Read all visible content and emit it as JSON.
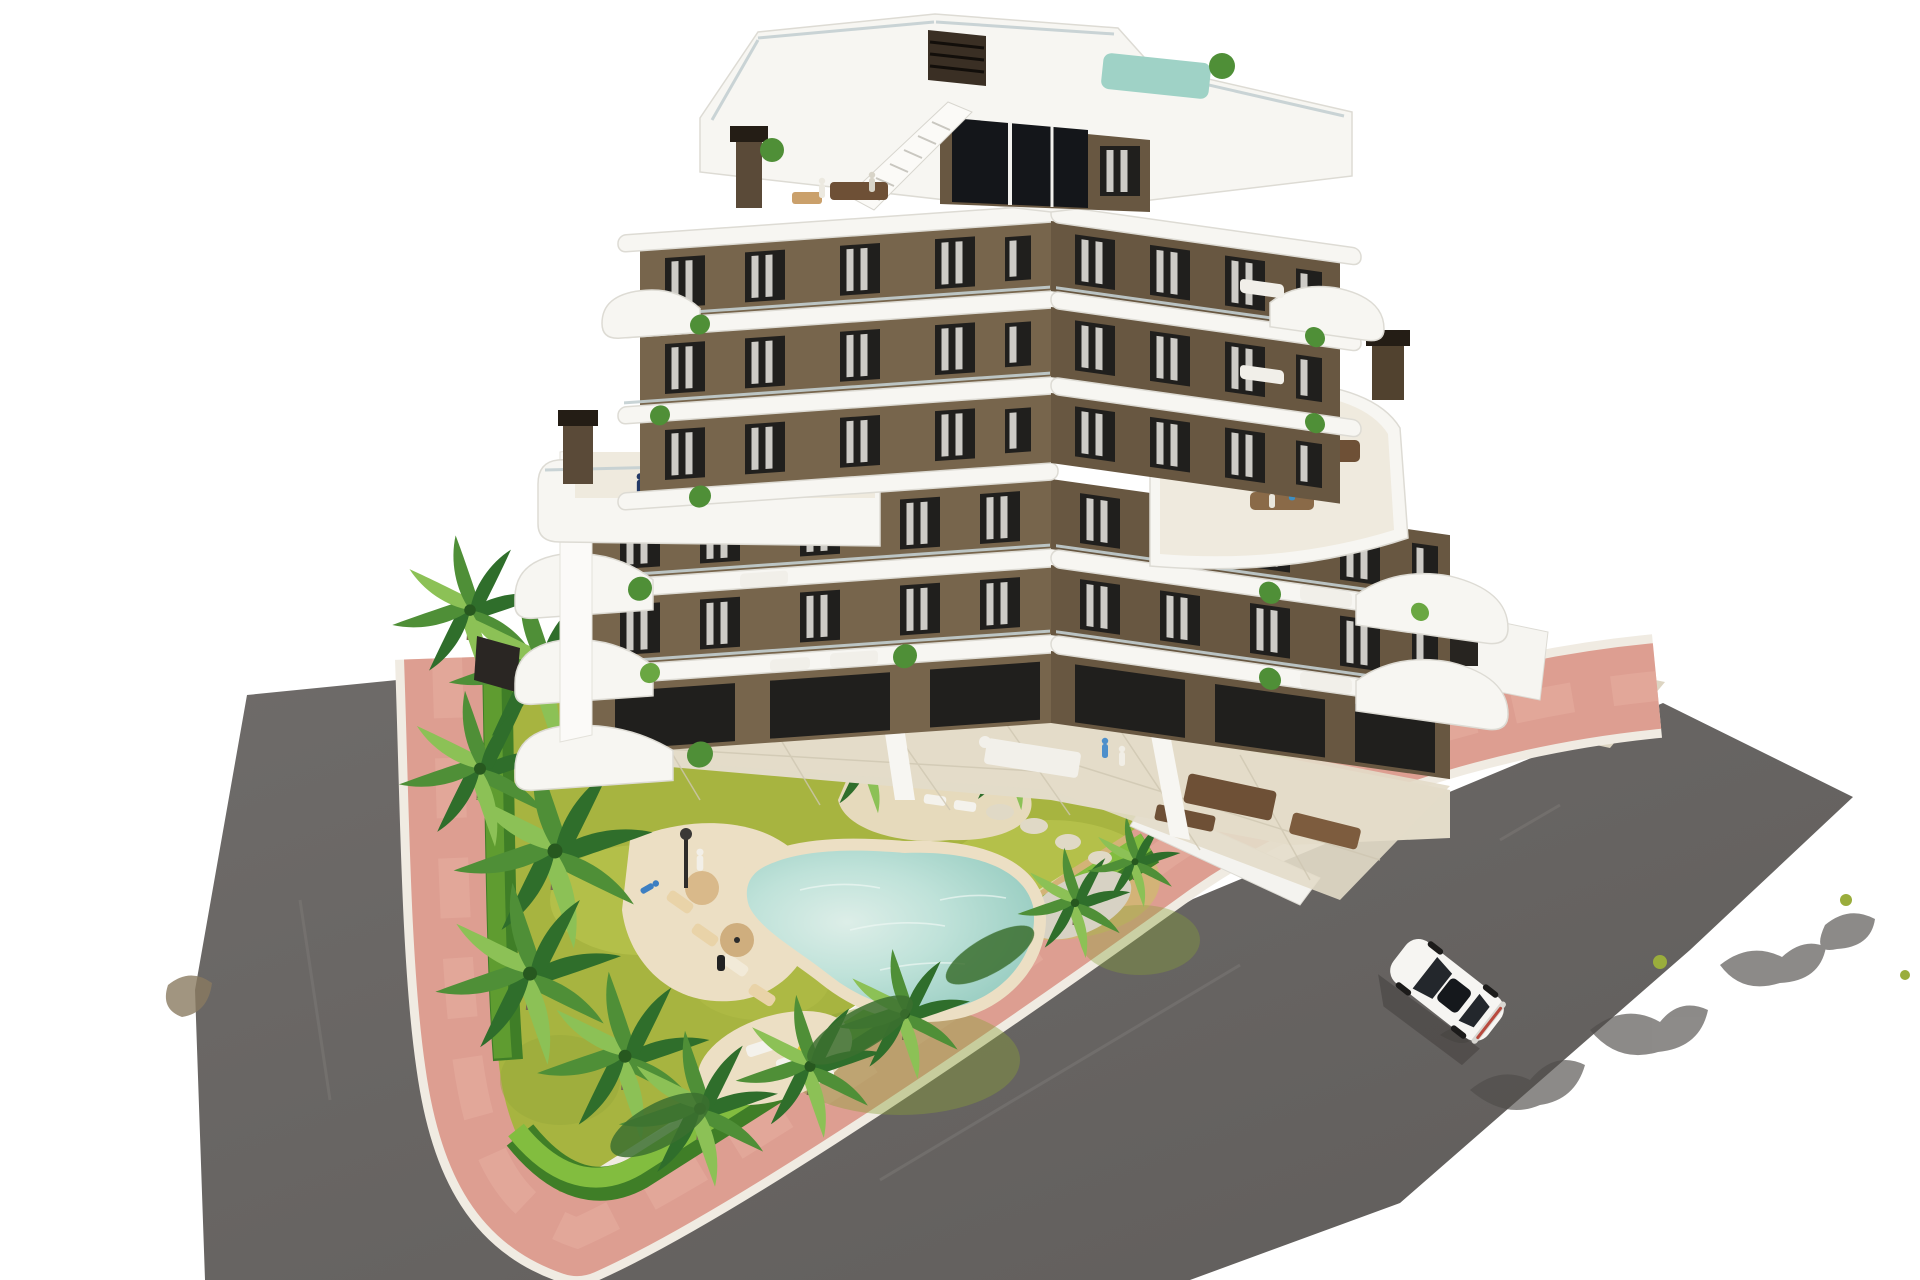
{
  "scene": {
    "title": "Aerial 3D render of modern apartment building with garden, pool and streets",
    "building": {
      "floors_visible": 7,
      "style": "stepped white wavy balcony bands over brown walls",
      "features": [
        "roof deck",
        "rooftop plunge pool",
        "roof stair",
        "two chimneys per wing",
        "glass balustrades",
        "penthouse glass wall",
        "large 5th-floor terraces",
        "ground-floor tiled terraces with dining sets"
      ]
    },
    "garden": {
      "features": [
        "kidney/boot shaped pool with sandy beach edge",
        "sun loungers",
        "parasols",
        "lawn",
        "palm trees",
        "trimmed hedge border",
        "palm island with gravel",
        "lamp post",
        "stepping stones"
      ]
    },
    "streets": {
      "left_road": "dark asphalt, widening wedge",
      "right_road": "dark asphalt with tree shadows",
      "walkway": "salmon pink paved path with white curbs wrapping the plot",
      "pavement": "cream sidewalk at upper right",
      "car": {
        "color": "white",
        "type": "sedan",
        "heading": "up-right on right road"
      }
    },
    "people_visible": 8
  },
  "colors": {
    "bg": "#ffffff",
    "road": "#6a6765",
    "roadDark": "#5d5a58",
    "shadow": "#4c4947",
    "curb": "#f0ebe2",
    "pink": "#dd9e91",
    "pinkLight": "#e8b2a4",
    "cream": "#ddd5c2",
    "tile": "#e3dcc9",
    "lawn": "#a7b440",
    "lawnLight": "#c6cf58",
    "lawnDark": "#8aa238",
    "hedge": "#5f9c30",
    "hedgeLight": "#82bd3f",
    "palm": "#4f8f37",
    "palmDark": "#2f6e2b",
    "palmLight": "#8cc156",
    "sand": "#ecdfc4",
    "poolDeep": "#9fd2c6",
    "poolLight": "#d8ece5",
    "wall": "#77654c",
    "walldark": "#685741",
    "slab": "#f7f6f2",
    "slabedge": "#dddbd4",
    "window": "#201f1d",
    "curtain": "#eceae4",
    "glass": "#c3cfd1",
    "chimney": "#362c21",
    "furniture": "#6e5036",
    "carBody": "#f6f5f2",
    "carGlass": "#23272c"
  }
}
